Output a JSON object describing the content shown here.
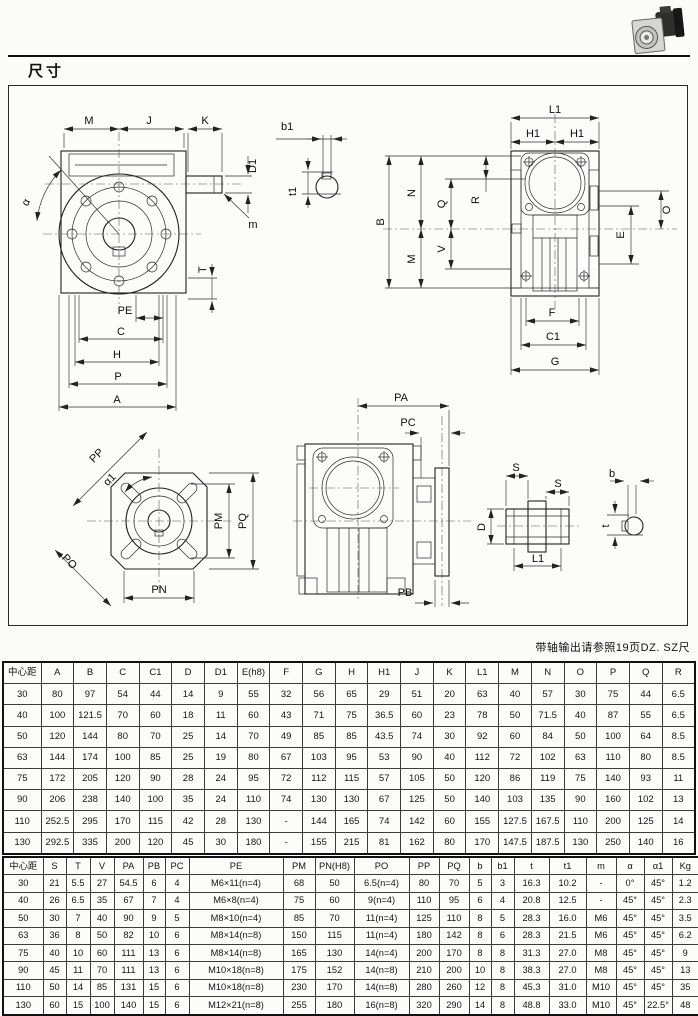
{
  "page": {
    "heading": "尺寸",
    "note": "带轴输出请参照19页DZ. SZ尺",
    "ink_color": "#111111",
    "paper_color": "#fbfbfa"
  },
  "drawings": {
    "front": {
      "M": "M",
      "J": "J",
      "K": "K",
      "D1": "D1",
      "m": "m",
      "alpha": "α",
      "T": "T",
      "PE": "PE",
      "C": "C",
      "H": "H",
      "P": "P",
      "A": "A"
    },
    "key": {
      "b1": "b1",
      "t1": "t1"
    },
    "side": {
      "L1": "L1",
      "H1a": "H1",
      "H1b": "H1",
      "B": "B",
      "N": "N",
      "M": "M",
      "Q": "Q",
      "V": "V",
      "R": "R",
      "O": "O",
      "E": "E",
      "F": "F",
      "C1": "C1",
      "G": "G"
    },
    "flange": {
      "PP": "PP",
      "alpha1": "α1",
      "PM": "PM",
      "PQ": "PQ",
      "PO": "PO",
      "PN": "PN"
    },
    "side2": {
      "PA": "PA",
      "PC": "PC",
      "PB": "PB"
    },
    "shaft": {
      "S1": "S",
      "S2": "S",
      "D": "D",
      "L1": "L1",
      "b": "b",
      "t": "t"
    }
  },
  "tables": [
    {
      "columns": [
        "中心距",
        "A",
        "B",
        "C",
        "C1",
        "D",
        "D1",
        "E(h8)",
        "F",
        "G",
        "H",
        "H1",
        "J",
        "K",
        "L1",
        "M",
        "N",
        "O",
        "P",
        "Q",
        "R"
      ],
      "rows": [
        [
          "30",
          "80",
          "97",
          "54",
          "44",
          "14",
          "9",
          "55",
          "32",
          "56",
          "65",
          "29",
          "51",
          "20",
          "63",
          "40",
          "57",
          "30",
          "75",
          "44",
          "6.5"
        ],
        [
          "40",
          "100",
          "121.5",
          "70",
          "60",
          "18",
          "11",
          "60",
          "43",
          "71",
          "75",
          "36.5",
          "60",
          "23",
          "78",
          "50",
          "71.5",
          "40",
          "87",
          "55",
          "6.5"
        ],
        [
          "50",
          "120",
          "144",
          "80",
          "70",
          "25",
          "14",
          "70",
          "49",
          "85",
          "85",
          "43.5",
          "74",
          "30",
          "92",
          "60",
          "84",
          "50",
          "100",
          "64",
          "8.5"
        ],
        [
          "63",
          "144",
          "174",
          "100",
          "85",
          "25",
          "19",
          "80",
          "67",
          "103",
          "95",
          "53",
          "90",
          "40",
          "112",
          "72",
          "102",
          "63",
          "110",
          "80",
          "8.5"
        ],
        [
          "75",
          "172",
          "205",
          "120",
          "90",
          "28",
          "24",
          "95",
          "72",
          "112",
          "115",
          "57",
          "105",
          "50",
          "120",
          "86",
          "119",
          "75",
          "140",
          "93",
          "11"
        ],
        [
          "90",
          "206",
          "238",
          "140",
          "100",
          "35",
          "24",
          "110",
          "74",
          "130",
          "130",
          "67",
          "125",
          "50",
          "140",
          "103",
          "135",
          "90",
          "160",
          "102",
          "13"
        ],
        [
          "110",
          "252.5",
          "295",
          "170",
          "115",
          "42",
          "28",
          "130",
          "-",
          "144",
          "165",
          "74",
          "142",
          "60",
          "155",
          "127.5",
          "167.5",
          "110",
          "200",
          "125",
          "14"
        ],
        [
          "130",
          "292.5",
          "335",
          "200",
          "120",
          "45",
          "30",
          "180",
          "-",
          "155",
          "215",
          "81",
          "162",
          "80",
          "170",
          "147.5",
          "187.5",
          "130",
          "250",
          "140",
          "16"
        ]
      ]
    },
    {
      "columns": [
        "中心距",
        "S",
        "T",
        "V",
        "PA",
        "PB",
        "PC",
        "PE",
        "PM",
        "PN(H8)",
        "PO",
        "PP",
        "PQ",
        "b",
        "b1",
        "t",
        "t1",
        "m",
        "α",
        "α1",
        "Kg"
      ],
      "rows": [
        [
          "30",
          "21",
          "5.5",
          "27",
          "54.5",
          "6",
          "4",
          "M6×11(n=4)",
          "68",
          "50",
          "6.5(n=4)",
          "80",
          "70",
          "5",
          "3",
          "16.3",
          "10.2",
          "-",
          "0°",
          "45°",
          "1.2"
        ],
        [
          "40",
          "26",
          "6.5",
          "35",
          "67",
          "7",
          "4",
          "M6×8(n=4)",
          "75",
          "60",
          "9(n=4)",
          "110",
          "95",
          "6",
          "4",
          "20.8",
          "12.5",
          "-",
          "45°",
          "45°",
          "2.3"
        ],
        [
          "50",
          "30",
          "7",
          "40",
          "90",
          "9",
          "5",
          "M8×10(n=4)",
          "85",
          "70",
          "11(n=4)",
          "125",
          "110",
          "8",
          "5",
          "28.3",
          "16.0",
          "M6",
          "45°",
          "45°",
          "3.5"
        ],
        [
          "63",
          "36",
          "8",
          "50",
          "82",
          "10",
          "6",
          "M8×14(n=8)",
          "150",
          "115",
          "11(n=4)",
          "180",
          "142",
          "8",
          "6",
          "28.3",
          "21.5",
          "M6",
          "45°",
          "45°",
          "6.2"
        ],
        [
          "75",
          "40",
          "10",
          "60",
          "111",
          "13",
          "6",
          "M8×14(n=8)",
          "165",
          "130",
          "14(n=4)",
          "200",
          "170",
          "8",
          "8",
          "31.3",
          "27.0",
          "M8",
          "45°",
          "45°",
          "9"
        ],
        [
          "90",
          "45",
          "11",
          "70",
          "111",
          "13",
          "6",
          "M10×18(n=8)",
          "175",
          "152",
          "14(n=8)",
          "210",
          "200",
          "10",
          "8",
          "38.3",
          "27.0",
          "M8",
          "45°",
          "45°",
          "13"
        ],
        [
          "110",
          "50",
          "14",
          "85",
          "131",
          "15",
          "6",
          "M10×18(n=8)",
          "230",
          "170",
          "14(n=8)",
          "280",
          "260",
          "12",
          "8",
          "45.3",
          "31.0",
          "M10",
          "45°",
          "45°",
          "35"
        ],
        [
          "130",
          "60",
          "15",
          "100",
          "140",
          "15",
          "6",
          "M12×21(n=8)",
          "255",
          "180",
          "16(n=8)",
          "320",
          "290",
          "14",
          "8",
          "48.8",
          "33.0",
          "M10",
          "45°",
          "22.5°",
          "48"
        ]
      ]
    }
  ]
}
